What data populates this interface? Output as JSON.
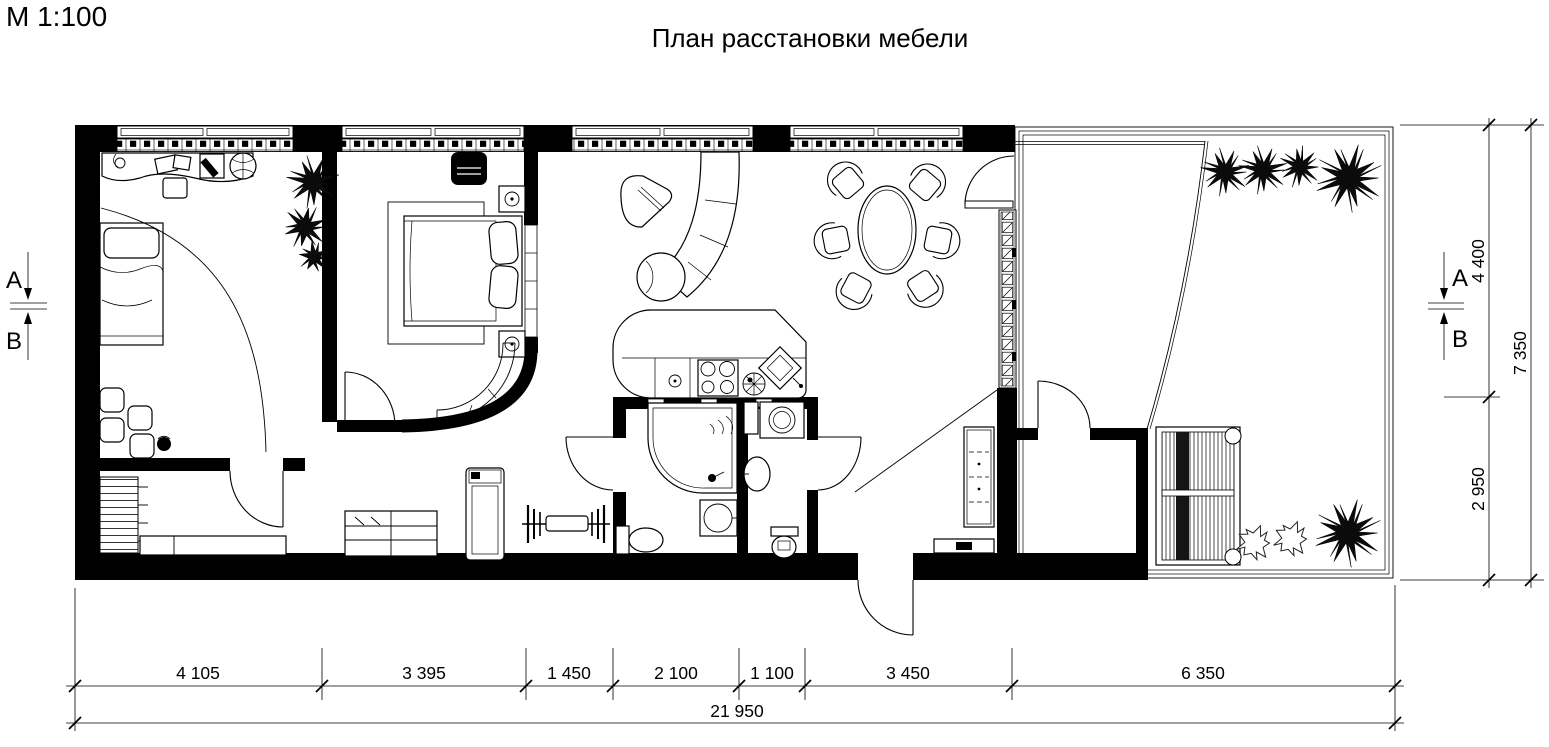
{
  "meta": {
    "scale_label": "М 1:100",
    "title": "План расстановки мебели"
  },
  "section_markers": {
    "a": "A",
    "b": "B"
  },
  "dimensions": {
    "bottom_segments": [
      "4 105",
      "3 395",
      "1 450",
      "2 100",
      "1 100",
      "3 450",
      "6 350"
    ],
    "bottom_total": "21 950",
    "right_segments": [
      "4 400",
      "2 950"
    ],
    "right_total": "7 350"
  },
  "colors": {
    "line": "#000000",
    "background": "#ffffff"
  }
}
